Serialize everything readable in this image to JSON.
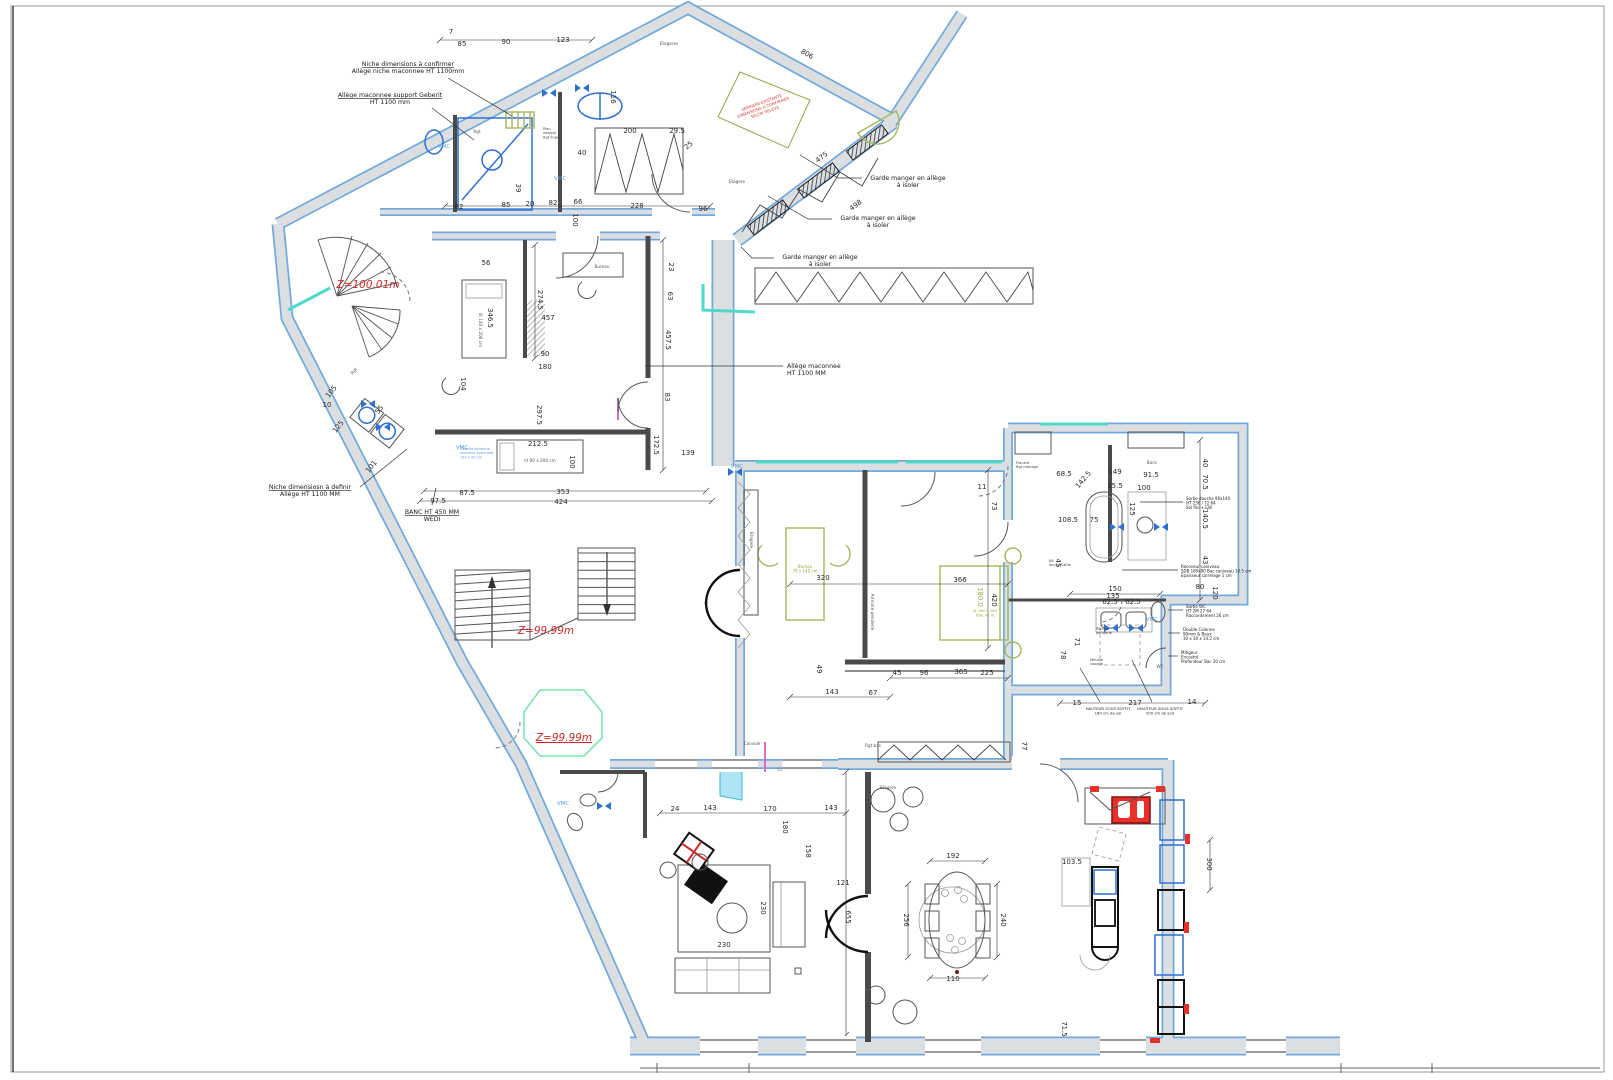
{
  "document": {
    "type": "Architectural floor plan",
    "language": "French",
    "units": "cm"
  },
  "colors": {
    "wall_fill": "#dcdfe2",
    "wall_edge": "#74a9dc",
    "dim_text": "#2b2b2b",
    "level_text": "#cc2a2a",
    "vmc_text": "#5b9bd5",
    "green_furniture": "#97a83f",
    "fixture_blue": "#2f6fd0",
    "accent_red": "#e8302a",
    "glazing_teal": "#4fd9cc"
  },
  "levels": [
    {
      "text": "Z=100.01m",
      "x": 368,
      "y": 288
    },
    {
      "text": "Z=99.99m",
      "x": 546,
      "y": 634
    },
    {
      "text": "Z=99.99m",
      "x": 564,
      "y": 741,
      "u": true
    }
  ],
  "vmc": {
    "label": "VMC",
    "positions": [
      {
        "x": 444,
        "y": 148
      },
      {
        "x": 560,
        "y": 180
      },
      {
        "x": 462,
        "y": 449
      },
      {
        "x": 737,
        "y": 468
      },
      {
        "x": 563,
        "y": 805
      },
      {
        "x": 1152,
        "y": 621
      }
    ]
  },
  "annotations": [
    {
      "x": 408,
      "y": 66,
      "a": "middle",
      "u1": true,
      "lines": [
        "Niche dimensions à confirmer",
        "Allège niche maconnee HT 1100mm"
      ],
      "leader": [
        [
          448,
          78
        ],
        [
          512,
          116
        ]
      ]
    },
    {
      "x": 390,
      "y": 97,
      "a": "middle",
      "u1": true,
      "lines": [
        "Allège maconnee support Geberit",
        "HT 1100 mm"
      ],
      "leader": [
        [
          432,
          108
        ],
        [
          474,
          140
        ]
      ]
    },
    {
      "x": 908,
      "y": 180,
      "a": "middle",
      "lines": [
        "Garde manger en allège",
        "à isoler"
      ],
      "leader": [
        [
          862,
          178
        ],
        [
          838,
          178
        ],
        [
          800,
          155
        ]
      ]
    },
    {
      "x": 878,
      "y": 220,
      "a": "middle",
      "lines": [
        "Garde manger en allège",
        "à isoler"
      ],
      "leader": [
        [
          832,
          219
        ],
        [
          808,
          219
        ],
        [
          768,
          196
        ]
      ]
    },
    {
      "x": 820,
      "y": 259,
      "a": "middle",
      "lines": [
        "Garde manger en allège",
        "à isoler"
      ],
      "leader": [
        [
          774,
          258
        ],
        [
          752,
          258
        ],
        [
          741,
          247
        ]
      ]
    },
    {
      "x": 787,
      "y": 368,
      "a": "start",
      "lines": [
        "Allège maconnee",
        "HT 1100 MM"
      ],
      "leader": [
        [
          783,
          366
        ],
        [
          645,
          366
        ]
      ]
    },
    {
      "x": 310,
      "y": 489,
      "a": "middle",
      "u1": true,
      "lines": [
        "Niche dimensiosn à definir",
        "Allège HT 1100 MM"
      ],
      "leader": [
        [
          360,
          487
        ],
        [
          407,
          449
        ]
      ]
    },
    {
      "x": 432,
      "y": 514,
      "a": "middle",
      "u1": true,
      "lines": [
        "BANC HT 450 MM",
        "WEDI"
      ],
      "leader": [
        [
          432,
          505
        ],
        [
          436,
          488
        ]
      ]
    },
    {
      "x": 1186,
      "y": 500,
      "s": 4,
      "a": "start",
      "lh": 4.6,
      "lines": [
        "Sortie douche 90x140",
        "HT 236 / 72 64",
        "Sol fini +328"
      ],
      "leader": [
        [
          1183,
          502
        ],
        [
          1140,
          502
        ]
      ]
    },
    {
      "x": 1181,
      "y": 568,
      "s": 4,
      "a": "start",
      "lh": 4.6,
      "lines": [
        "Receveur caniveau",
        "SDB 180x90 Bac caniveau 10.5 cm",
        "Epaisseur carrelage 1 cm"
      ],
      "leader": [
        [
          1178,
          570
        ],
        [
          1122,
          570
        ]
      ]
    },
    {
      "x": 1186,
      "y": 608,
      "s": 4,
      "a": "start",
      "lh": 4.6,
      "lines": [
        "Sortie WC",
        "HT 2M 27 64",
        "Raccordement 26 cm"
      ],
      "leader": [
        [
          1183,
          610
        ],
        [
          1168,
          610
        ]
      ]
    },
    {
      "x": 1183,
      "y": 631,
      "s": 4,
      "a": "start",
      "lh": 4.6,
      "lines": [
        "Double Colonne",
        "90mm & Baux",
        "30 x 30 x 14.2 cm"
      ],
      "leader": [
        [
          1180,
          633
        ],
        [
          1168,
          633
        ]
      ]
    },
    {
      "x": 1181,
      "y": 654,
      "s": 4,
      "a": "start",
      "lh": 4.6,
      "lines": [
        "Mitigeur",
        "Encastré",
        "Profondeur Bac 20 cm"
      ],
      "leader": [
        [
          1178,
          656
        ],
        [
          1168,
          656
        ]
      ]
    },
    {
      "x": 1108,
      "y": 710,
      "s": 3.8,
      "a": "middle",
      "lh": 4.4,
      "lines": [
        "HAUTEUR SOUS SOFFIT",
        "180 cm de sol"
      ],
      "leader": [
        [
          1100,
          702
        ],
        [
          1080,
          668
        ]
      ]
    },
    {
      "x": 1160,
      "y": 710,
      "s": 3.8,
      "a": "middle",
      "lh": 4.4,
      "lines": [
        "(HAUTEUR SOUS SOFFIT",
        "200 cm de sol)"
      ],
      "leader": [
        [
          1152,
          702
        ],
        [
          1132,
          660
        ]
      ]
    },
    {
      "x": 762,
      "y": 104,
      "s": 4,
      "a": "middle",
      "lh": 5,
      "r": -20,
      "c": "#d04040",
      "lines": [
        "VERRIERE EXISTANTE",
        "DIMENSIONS A CONFIRMER",
        "SELON RELEVE"
      ]
    },
    {
      "x": 460,
      "y": 450,
      "s": 3.5,
      "a": "start",
      "lh": 4.2,
      "c": "#5b9bd5",
      "lines": [
        "Douche italienne",
        "receveur extra plat",
        "150 x 90 cm"
      ]
    },
    {
      "x": 805,
      "y": 568,
      "s": 4,
      "a": "middle",
      "lh": 4.6,
      "c": "#97a83f",
      "lines": [
        "Bureau",
        "70 x 140 cm"
      ]
    },
    {
      "x": 985,
      "y": 612,
      "s": 3.8,
      "a": "middle",
      "lh": 4.4,
      "c": "#97a83f",
      "lines": [
        "lit 160 x 200",
        "tête de lit"
      ]
    },
    {
      "x": 543,
      "y": 130,
      "s": 3.6,
      "a": "start",
      "lh": 4.2,
      "c": "#444",
      "lines": [
        "Plan",
        "vasque +",
        "Rgt linge"
      ]
    },
    {
      "x": 1016,
      "y": 464,
      "s": 3.6,
      "a": "start",
      "lh": 4.2,
      "c": "#444",
      "lines": [
        "Placard",
        "Rgt ménage"
      ]
    },
    {
      "x": 1049,
      "y": 562,
      "s": 3.6,
      "a": "start",
      "lh": 4.2,
      "c": "#444",
      "lines": [
        "Kit",
        "Acces Cable"
      ]
    },
    {
      "x": 1096,
      "y": 630,
      "s": 3.6,
      "a": "start",
      "lh": 4.2,
      "c": "#444",
      "lines": [
        "Placard",
        "penderie"
      ]
    },
    {
      "x": 1090,
      "y": 661,
      "s": 3.6,
      "a": "start",
      "lh": 4.2,
      "c": "#444",
      "lines": [
        "Meuble",
        "vasque"
      ]
    }
  ],
  "labels": [
    {
      "t": "Etageres",
      "x": 669,
      "y": 45
    },
    {
      "t": "Rgt",
      "x": 477,
      "y": 133
    },
    {
      "t": "Etagere",
      "x": 737,
      "y": 183
    },
    {
      "t": "Bureau",
      "x": 602,
      "y": 268
    },
    {
      "t": "lit 140 x 200 cm",
      "x": 479,
      "y": 330,
      "r": 90
    },
    {
      "t": "lit 90 x 200 cm",
      "x": 540,
      "y": 462
    },
    {
      "t": "Armoire penderie",
      "x": 871,
      "y": 612,
      "r": 90
    },
    {
      "t": "Banc",
      "x": 1152,
      "y": 464
    },
    {
      "t": "WC",
      "x": 1160,
      "y": 668
    },
    {
      "t": "Rgt bas",
      "x": 873,
      "y": 747
    },
    {
      "t": "Etagere",
      "x": 888,
      "y": 789
    },
    {
      "t": "Colonne",
      "x": 786,
      "y": 771
    },
    {
      "t": "Console",
      "x": 752,
      "y": 745
    },
    {
      "t": "Etagere",
      "x": 750,
      "y": 540,
      "r": 90
    },
    {
      "t": "Rgt",
      "x": 355,
      "y": 372,
      "r": -52
    }
  ],
  "dimensions": [
    {
      "v": "7",
      "x": 451,
      "y": 34
    },
    {
      "v": "85",
      "x": 462,
      "y": 46
    },
    {
      "v": "90",
      "x": 506,
      "y": 44
    },
    {
      "v": "123",
      "x": 563,
      "y": 42
    },
    {
      "v": "806",
      "x": 806,
      "y": 56,
      "r": 30
    },
    {
      "v": "475",
      "x": 823,
      "y": 159,
      "r": -37
    },
    {
      "v": "498",
      "x": 857,
      "y": 207,
      "r": -37
    },
    {
      "v": "82",
      "x": 459,
      "y": 209
    },
    {
      "v": "85",
      "x": 506,
      "y": 207
    },
    {
      "v": "20",
      "x": 530,
      "y": 206
    },
    {
      "v": "82",
      "x": 553,
      "y": 205
    },
    {
      "v": "66",
      "x": 578,
      "y": 204
    },
    {
      "v": "228",
      "x": 637,
      "y": 208
    },
    {
      "v": "96",
      "x": 703,
      "y": 211
    },
    {
      "v": "100",
      "x": 573,
      "y": 220,
      "r": 90
    },
    {
      "v": "39",
      "x": 516,
      "y": 188,
      "r": 90
    },
    {
      "v": "40",
      "x": 582,
      "y": 155
    },
    {
      "v": "116",
      "x": 611,
      "y": 97,
      "r": 90
    },
    {
      "v": "200",
      "x": 630,
      "y": 133
    },
    {
      "v": "29.5",
      "x": 677,
      "y": 133
    },
    {
      "v": "25",
      "x": 690,
      "y": 147,
      "r": -40
    },
    {
      "v": "10",
      "x": 327,
      "y": 407
    },
    {
      "v": "105",
      "x": 333,
      "y": 393,
      "r": -52
    },
    {
      "v": "55",
      "x": 381,
      "y": 411,
      "r": -52
    },
    {
      "v": "125",
      "x": 340,
      "y": 428,
      "r": -52
    },
    {
      "v": "101",
      "x": 373,
      "y": 468,
      "r": -52
    },
    {
      "v": "104",
      "x": 461,
      "y": 384,
      "r": 90
    },
    {
      "v": "56",
      "x": 486,
      "y": 265
    },
    {
      "v": "274.5",
      "x": 538,
      "y": 300,
      "r": 90
    },
    {
      "v": "457",
      "x": 548,
      "y": 320
    },
    {
      "v": "346.5",
      "x": 488,
      "y": 318,
      "r": 90
    },
    {
      "v": "90",
      "x": 545,
      "y": 356
    },
    {
      "v": "180",
      "x": 545,
      "y": 369
    },
    {
      "v": "297.5",
      "x": 537,
      "y": 415,
      "r": 90
    },
    {
      "v": "212.5",
      "x": 538,
      "y": 446
    },
    {
      "v": "100",
      "x": 570,
      "y": 462,
      "r": 90
    },
    {
      "v": "353",
      "x": 563,
      "y": 494
    },
    {
      "v": "424",
      "x": 561,
      "y": 504
    },
    {
      "v": "87.5",
      "x": 467,
      "y": 495
    },
    {
      "v": "97.5",
      "x": 438,
      "y": 503
    },
    {
      "v": "23",
      "x": 669,
      "y": 267,
      "r": 90
    },
    {
      "v": "63",
      "x": 668,
      "y": 296,
      "r": 90
    },
    {
      "v": "457.5",
      "x": 666,
      "y": 340,
      "r": 90
    },
    {
      "v": "83",
      "x": 665,
      "y": 397,
      "r": 90
    },
    {
      "v": "172.5",
      "x": 654,
      "y": 445,
      "r": 90
    },
    {
      "v": "139",
      "x": 688,
      "y": 455
    },
    {
      "v": "320",
      "x": 823,
      "y": 580
    },
    {
      "v": "366",
      "x": 960,
      "y": 582
    },
    {
      "v": "420",
      "x": 992,
      "y": 600,
      "r": 90
    },
    {
      "v": "73",
      "x": 992,
      "y": 506,
      "r": 90
    },
    {
      "v": "11",
      "x": 982,
      "y": 489
    },
    {
      "v": "45",
      "x": 897,
      "y": 675
    },
    {
      "v": "96",
      "x": 924,
      "y": 675
    },
    {
      "v": "365",
      "x": 961,
      "y": 674
    },
    {
      "v": "225",
      "x": 987,
      "y": 675
    },
    {
      "v": "143",
      "x": 832,
      "y": 694
    },
    {
      "v": "67",
      "x": 873,
      "y": 695
    },
    {
      "v": "49",
      "x": 817,
      "y": 669,
      "r": 90
    },
    {
      "v": "180.0",
      "x": 978,
      "y": 597,
      "r": 90,
      "c": "#97a83f"
    },
    {
      "v": "24",
      "x": 675,
      "y": 811
    },
    {
      "v": "143",
      "x": 710,
      "y": 810
    },
    {
      "v": "170",
      "x": 770,
      "y": 811
    },
    {
      "v": "143",
      "x": 831,
      "y": 810
    },
    {
      "v": "180",
      "x": 783,
      "y": 827,
      "r": 90
    },
    {
      "v": "158",
      "x": 806,
      "y": 851,
      "r": 90
    },
    {
      "v": "121",
      "x": 843,
      "y": 885
    },
    {
      "v": "655",
      "x": 846,
      "y": 917,
      "r": 90
    },
    {
      "v": "230",
      "x": 761,
      "y": 908,
      "r": 90
    },
    {
      "v": "230",
      "x": 724,
      "y": 947
    },
    {
      "v": "192",
      "x": 953,
      "y": 858
    },
    {
      "v": "256",
      "x": 904,
      "y": 920,
      "r": 90
    },
    {
      "v": "240",
      "x": 1001,
      "y": 920,
      "r": 90
    },
    {
      "v": "110",
      "x": 953,
      "y": 981
    },
    {
      "v": "103.5",
      "x": 1072,
      "y": 864
    },
    {
      "v": "300",
      "x": 1207,
      "y": 864,
      "r": 90
    },
    {
      "v": "71.5",
      "x": 1062,
      "y": 1029,
      "r": 90
    },
    {
      "v": "68.5",
      "x": 1064,
      "y": 476
    },
    {
      "v": "149",
      "x": 1115,
      "y": 474
    },
    {
      "v": "15.5",
      "x": 1115,
      "y": 488
    },
    {
      "v": "100",
      "x": 1144,
      "y": 490
    },
    {
      "v": "91.5",
      "x": 1151,
      "y": 477
    },
    {
      "v": "142.5",
      "x": 1085,
      "y": 481,
      "r": -50
    },
    {
      "v": "108.5",
      "x": 1068,
      "y": 522
    },
    {
      "v": "75",
      "x": 1094,
      "y": 522
    },
    {
      "v": "125",
      "x": 1130,
      "y": 509,
      "r": 90
    },
    {
      "v": "45",
      "x": 1056,
      "y": 563,
      "r": 90
    },
    {
      "v": "40",
      "x": 1203,
      "y": 463,
      "r": 90
    },
    {
      "v": "70.5",
      "x": 1203,
      "y": 482,
      "r": 90
    },
    {
      "v": "140.5",
      "x": 1203,
      "y": 519,
      "r": 90
    },
    {
      "v": "43",
      "x": 1203,
      "y": 560,
      "r": 90
    },
    {
      "v": "120",
      "x": 1213,
      "y": 593,
      "r": 90
    },
    {
      "v": "150",
      "x": 1115,
      "y": 591
    },
    {
      "v": "135",
      "x": 1113,
      "y": 598
    },
    {
      "v": "80",
      "x": 1200,
      "y": 589
    },
    {
      "v": "62.5",
      "x": 1110,
      "y": 604
    },
    {
      "v": "62.5",
      "x": 1133,
      "y": 604
    },
    {
      "v": "71",
      "x": 1075,
      "y": 642,
      "r": 90
    },
    {
      "v": "78",
      "x": 1061,
      "y": 655,
      "r": 90
    },
    {
      "v": "15",
      "x": 1077,
      "y": 705
    },
    {
      "v": "217",
      "x": 1135,
      "y": 705
    },
    {
      "v": "14",
      "x": 1192,
      "y": 704
    },
    {
      "v": "77",
      "x": 1022,
      "y": 746,
      "r": 90
    }
  ]
}
